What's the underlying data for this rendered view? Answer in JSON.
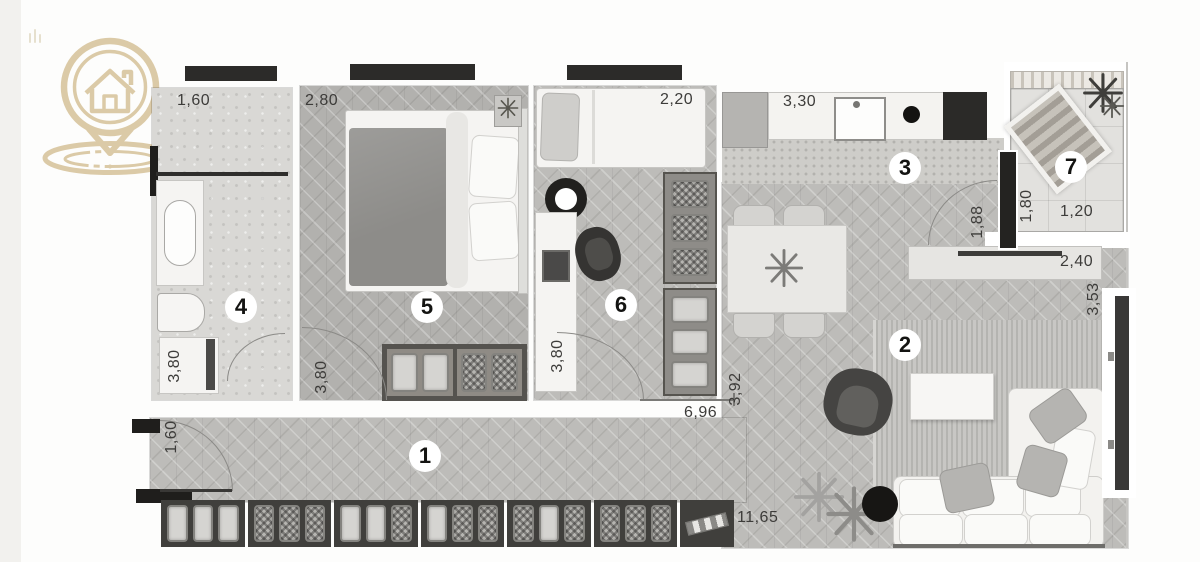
{
  "logo": {
    "name": "house-location-pin",
    "color": "#d8c59e"
  },
  "rooms": [
    {
      "number": "1",
      "name": "hallway"
    },
    {
      "number": "2",
      "name": "living-room"
    },
    {
      "number": "3",
      "name": "kitchen"
    },
    {
      "number": "4",
      "name": "bathroom"
    },
    {
      "number": "5",
      "name": "bedroom"
    },
    {
      "number": "6",
      "name": "office-bedroom"
    },
    {
      "number": "7",
      "name": "balcony"
    }
  ],
  "dims": {
    "bathroom_width": "1,60",
    "bathroom_depth": "3,80",
    "bedroom1_width": "2,80",
    "bedroom1_depth": "3,80",
    "bedroom2_width": "2,20",
    "bedroom2_depth": "3,80",
    "kitchen_width": "3,30",
    "kitchen_depth": "1,88",
    "balcony_depth": "1,80",
    "balcony_width": "1,20",
    "sideboard_width": "2,40",
    "living_depth": "3,53",
    "entry_width": "1,60",
    "hall_segment": "6,96",
    "hall_depth": "3,92",
    "hall_length": "11,65"
  },
  "colors": {
    "logo_beige": "#d8c59e",
    "wall_dark": "#2c2b29",
    "floor_wood": "#bdbcb9",
    "floor_concrete": "#d9d8d5",
    "floor_tile": "#e2e1de"
  },
  "wardrobe_modules": [
    {
      "boxes": [
        "plain",
        "plain",
        "plain"
      ]
    },
    {
      "boxes": [
        "woven",
        "woven",
        "woven"
      ]
    },
    {
      "boxes": [
        "plain",
        "plain",
        "woven"
      ]
    },
    {
      "boxes": [
        "plain",
        "woven",
        "woven"
      ]
    },
    {
      "boxes": [
        "woven",
        "plain",
        "woven"
      ]
    },
    {
      "boxes": [
        "woven",
        "woven",
        "woven"
      ]
    },
    {
      "boxes": [
        "slanted"
      ]
    }
  ]
}
